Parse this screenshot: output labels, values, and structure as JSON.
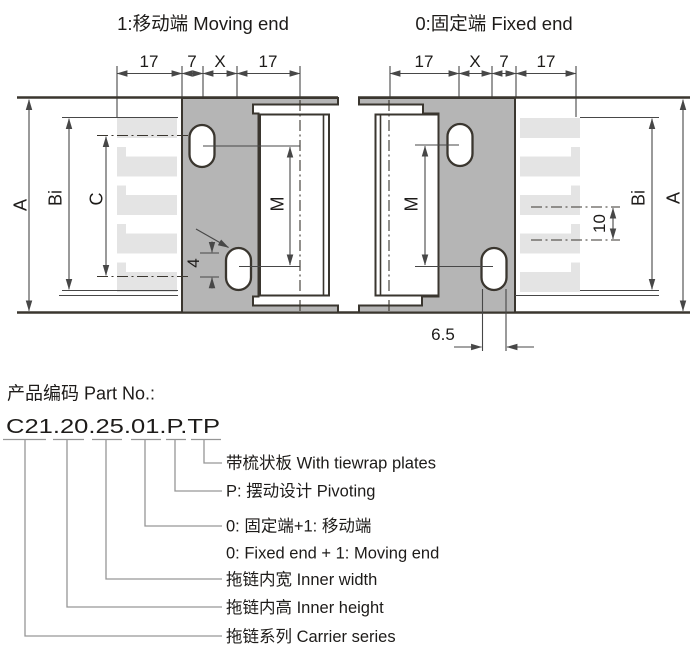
{
  "colors": {
    "bracket_fill": "#b5b5b5",
    "comb_fill": "#e4e4e4",
    "outline": "#3a362f",
    "dim_line": "#474747",
    "callout_line": "#969696",
    "text": "#1d1b19"
  },
  "moving_end": {
    "title": "1:移动端 Moving end",
    "top_dims": [
      "17",
      "7",
      "X",
      "17"
    ],
    "labels": {
      "a": "A",
      "bi": "Bi",
      "c": "C",
      "m": "M",
      "slot": "4"
    }
  },
  "fixed_end": {
    "title": "0:固定端 Fixed end",
    "top_dims": [
      "17",
      "X",
      "7",
      "17"
    ],
    "labels": {
      "m": "M",
      "pitch": "10",
      "bi": "Bi",
      "a": "A",
      "slot_width": "6.5"
    }
  },
  "part_no": {
    "heading": "产品编码 Part No.:",
    "code": "C21.20.25.01.P.TP",
    "callouts": [
      {
        "text": "带梳状板 With tiewrap plates"
      },
      {
        "text": "P: 摆动设计 Pivoting"
      },
      {
        "text": "0: 固定端+1: 移动端",
        "text2": "0: Fixed end + 1: Moving end"
      },
      {
        "text": "拖链内宽 Inner width"
      },
      {
        "text": "拖链内高 Inner height"
      },
      {
        "text": "拖链系列 Carrier series"
      }
    ]
  }
}
